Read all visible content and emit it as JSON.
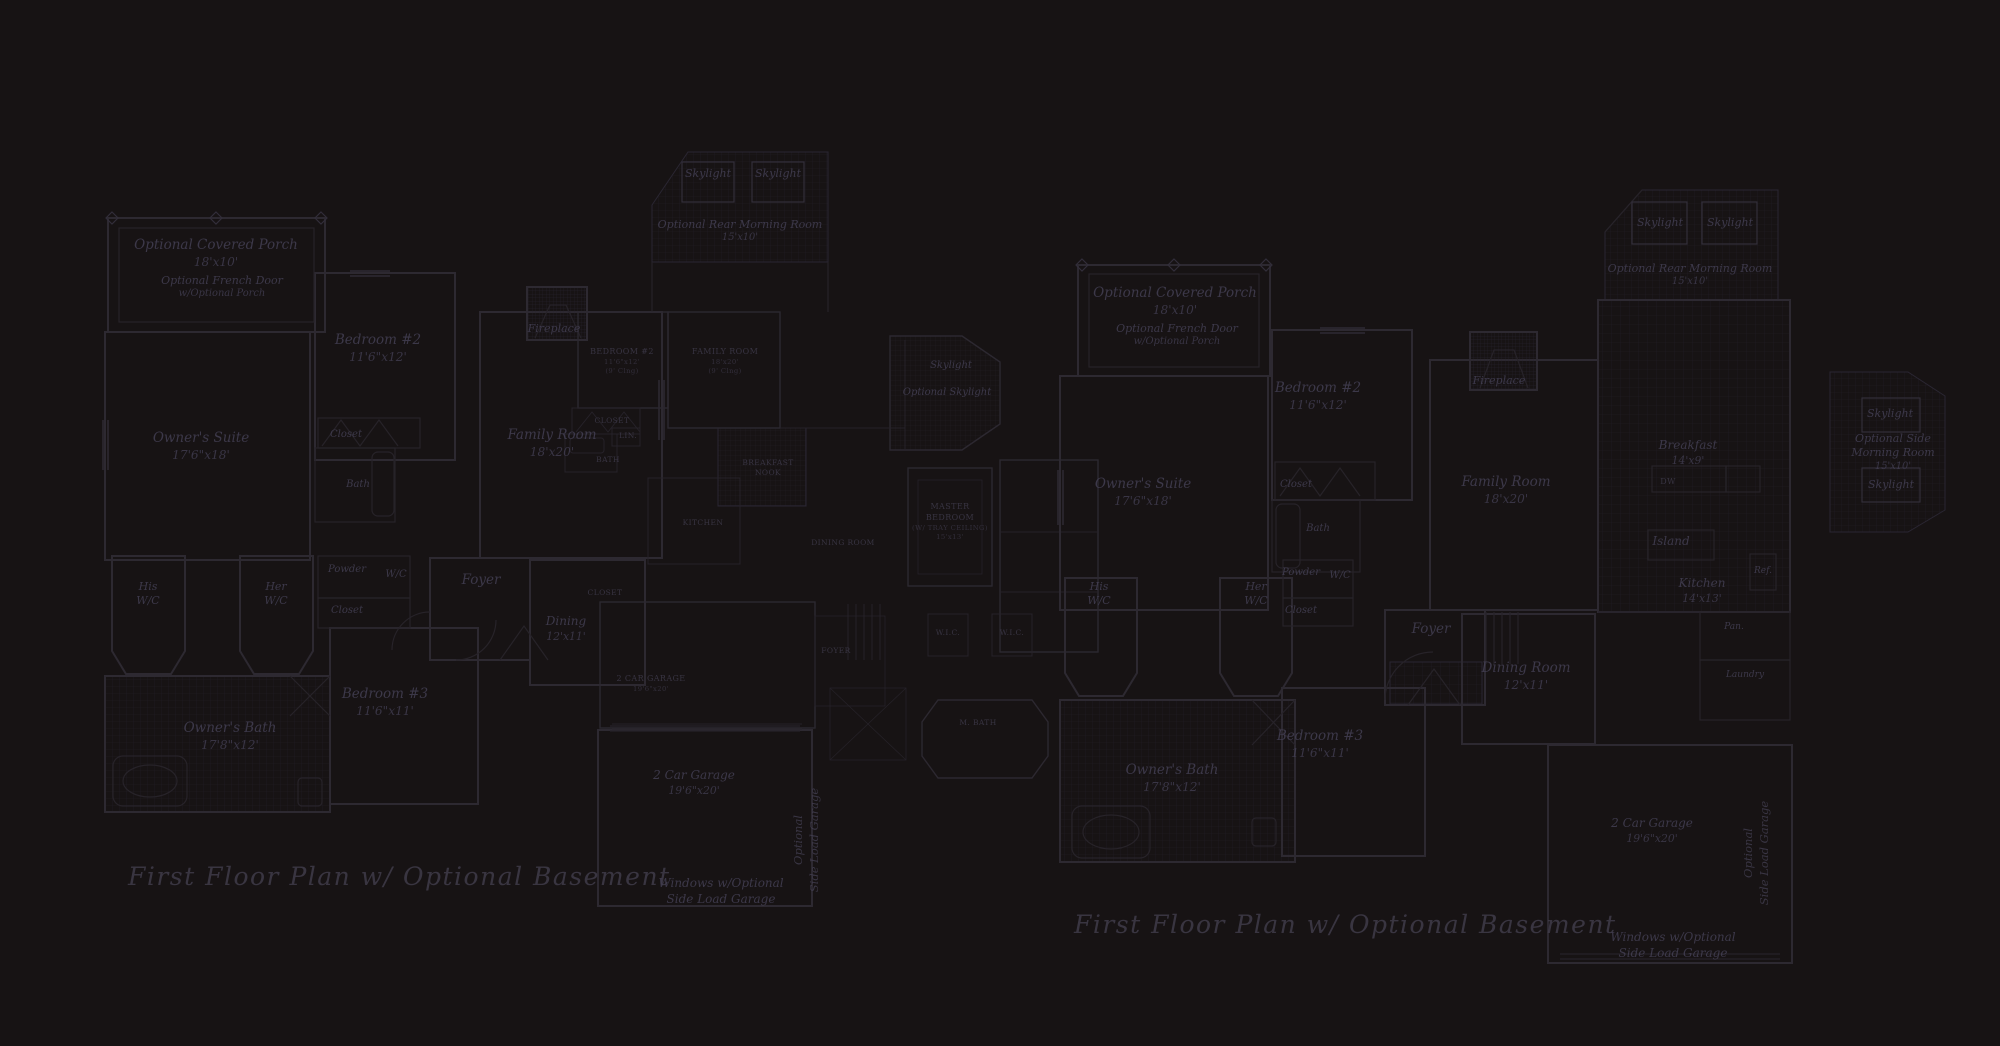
{
  "sheet": {
    "background": "#171314",
    "line_color": "#2d2931",
    "label_color": "#474359",
    "title_left": "First Floor Plan  w/ Optional Basement",
    "title_right": "First Floor Plan  w/ Optional Basement"
  },
  "plan_a": {
    "covered_porch": {
      "l1": "Optional Covered Porch",
      "l2": "18'x10'"
    },
    "french_door": {
      "l1": "Optional French Door",
      "l2": "w/Optional Porch"
    },
    "owners_suite": {
      "l1": "Owner's Suite",
      "l2": "17'6\"x18'"
    },
    "bedroom2": {
      "l1": "Bedroom #2",
      "l2": "11'6\"x12'"
    },
    "bedroom2_closet": "Closet",
    "bedroom2_bath": "Bath",
    "his_wc": {
      "l1": "His",
      "l2": "W/C"
    },
    "her_wc": {
      "l1": "Her",
      "l2": "W/C"
    },
    "powder": "Powder",
    "wc": "W/C",
    "hall_closet": "Closet",
    "foyer": "Foyer",
    "bedroom3": {
      "l1": "Bedroom #3",
      "l2": "11'6\"x11'"
    },
    "owners_bath": {
      "l1": "Owner's Bath",
      "l2": "17'8\"x12'"
    },
    "family_room": {
      "l1": "Family Room",
      "l2": "18'x20'"
    },
    "dining": {
      "l1": "Dining",
      "l2": "12'x11'"
    },
    "fireplace": "Fireplace",
    "skylight_left": "Skylight",
    "skylight_right": "Skylight",
    "morning_room": {
      "l1": "Optional Rear Morning Room",
      "l2": "15'x10'"
    },
    "garage": {
      "l1": "2 Car Garage",
      "l2": "19'6\"x20'"
    },
    "side_load": {
      "l1": "Optional",
      "l2": "Side Load Garage"
    },
    "windows_note": {
      "l1": "Windows w/Optional",
      "l2": "Side Load Garage"
    }
  },
  "plan_b": {
    "bedroom": {
      "l1": "BEDROOM #2",
      "l2": "11'6\"x12'",
      "l3": "(9' Clng)"
    },
    "family_room": {
      "l1": "FAMILY ROOM",
      "l2": "18'x20'",
      "l3": "(9' Clng)"
    },
    "closet": "CLOSET",
    "linen": "LIN.",
    "bath": "BATH",
    "breakfast": {
      "l1": "BREAKFAST",
      "l2": "NOOK"
    },
    "kitchen": "KITCHEN",
    "dining": "DINING ROOM",
    "master": {
      "l1": "MASTER",
      "l2": "BEDROOM",
      "l3": "(W/ TRAY CEILING)",
      "l4": "15'x13'"
    },
    "foyer": "FOYER",
    "wic_left": "W.I.C.",
    "wic_right": "W.I.C.",
    "master_closet": "CLOSET",
    "master_bath": "M. BATH",
    "garage": {
      "l1": "2 CAR GARAGE",
      "l2": "19'6\"x20'"
    },
    "skylight": "Skylight",
    "optional_skylight": "Optional Skylight"
  },
  "plan_c": {
    "covered_porch": {
      "l1": "Optional Covered Porch",
      "l2": "18'x10'"
    },
    "french_door": {
      "l1": "Optional French Door",
      "l2": "w/Optional Porch"
    },
    "owners_suite": {
      "l1": "Owner's Suite",
      "l2": "17'6\"x18'"
    },
    "bedroom2": {
      "l1": "Bedroom #2",
      "l2": "11'6\"x12'"
    },
    "bedroom2_closet": "Closet",
    "bedroom2_bath": "Bath",
    "his_wc": {
      "l1": "His",
      "l2": "W/C"
    },
    "her_wc": {
      "l1": "Her",
      "l2": "W/C"
    },
    "powder": "Powder",
    "wc": "W/C",
    "hall_closet": "Closet",
    "foyer": "Foyer",
    "bedroom3": {
      "l1": "Bedroom #3",
      "l2": "11'6\"x11'"
    },
    "owners_bath": {
      "l1": "Owner's Bath",
      "l2": "17'8\"x12'"
    },
    "family_room": {
      "l1": "Family Room",
      "l2": "18'x20'"
    },
    "fireplace": "Fireplace",
    "skylight_left": "Skylight",
    "skylight_right": "Skylight",
    "morning_room": {
      "l1": "Optional Rear Morning Room",
      "l2": "15'x10'"
    },
    "breakfast": {
      "l1": "Breakfast",
      "l2": "14'x9'"
    },
    "dw": "DW",
    "island": "Island",
    "kitchen": {
      "l1": "Kitchen",
      "l2": "14'x13'"
    },
    "ref": "Ref.",
    "pantry": "Pan.",
    "laundry": "Laundry",
    "dining": {
      "l1": "Dining Room",
      "l2": "12'x11'"
    },
    "garage": {
      "l1": "2 Car Garage",
      "l2": "19'6\"x20'"
    },
    "side_load": {
      "l1": "Optional",
      "l2": "Side Load Garage"
    },
    "windows_note": {
      "l1": "Windows w/Optional",
      "l2": "Side Load Garage"
    },
    "side_morning": {
      "sky_top": "Skylight",
      "l1": "Optional Side",
      "l2": "Morning Room",
      "l3": "15'x10'",
      "sky_bottom": "Skylight"
    }
  }
}
